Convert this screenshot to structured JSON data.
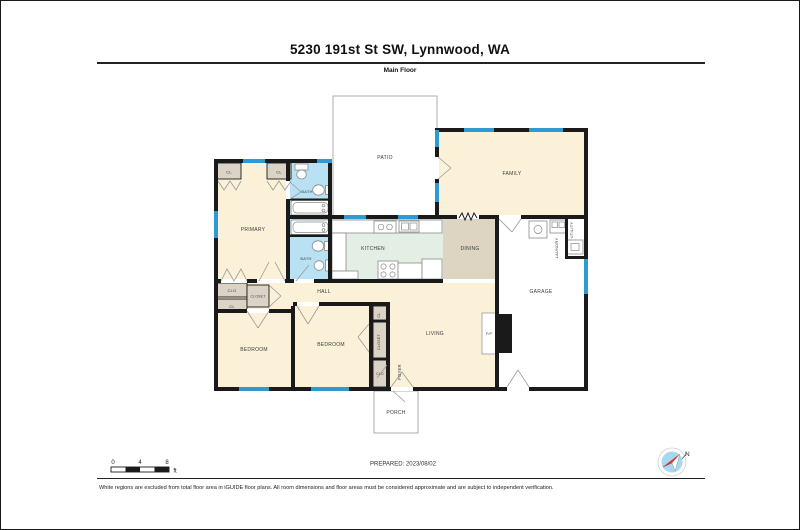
{
  "header": {
    "title": "5230 191st St SW, Lynnwood, WA",
    "subtitle": "Main Floor"
  },
  "rooms": {
    "patio": "PATIO",
    "family": "FAMILY",
    "primary": "PRIMARY",
    "kitchen": "KITCHEN",
    "dining": "DINING",
    "garage": "GARAGE",
    "hall": "HALL",
    "living": "LIVING",
    "foyer": "FOYER",
    "porch": "PORCH",
    "bedroom_left": "BEDROOM",
    "bedroom_mid": "BEDROOM",
    "bath_upper": "BATH",
    "bath_lower": "BATH",
    "laundry": "LAUNDRY",
    "utility": "UTILITY",
    "fireplace": "F/P",
    "cl_top_left": "CL",
    "cl_top_right": "CL",
    "clo_hall": "CLO",
    "closet_hall": "CLOSET",
    "cl_hall": "CL",
    "cl_col": "CL",
    "closet_col": "CLOSET",
    "clo_foyer": "CLO"
  },
  "scale": {
    "t0": "0",
    "t4": "4",
    "t8": "8",
    "unit": "ft"
  },
  "prepared": "PREPARED: 2023/08/02",
  "compass": {
    "north": "N"
  },
  "footer": "White regions are excluded from total floor area in iGUIDE floor plans. All room dimensions and floor areas must be considered approximate and are subject to independent verification.",
  "colors": {
    "wall": "#1a1a1a",
    "window": "#2f9ad1",
    "cream": "#faf1d8",
    "bath": "#b9e1f4",
    "kitchen": "#e3efe5",
    "dining": "#ded4c2",
    "closet": "#dad3c6",
    "open": "#ffffff",
    "compass_blue": "#a6d9f0",
    "needle_red": "#e63329"
  }
}
